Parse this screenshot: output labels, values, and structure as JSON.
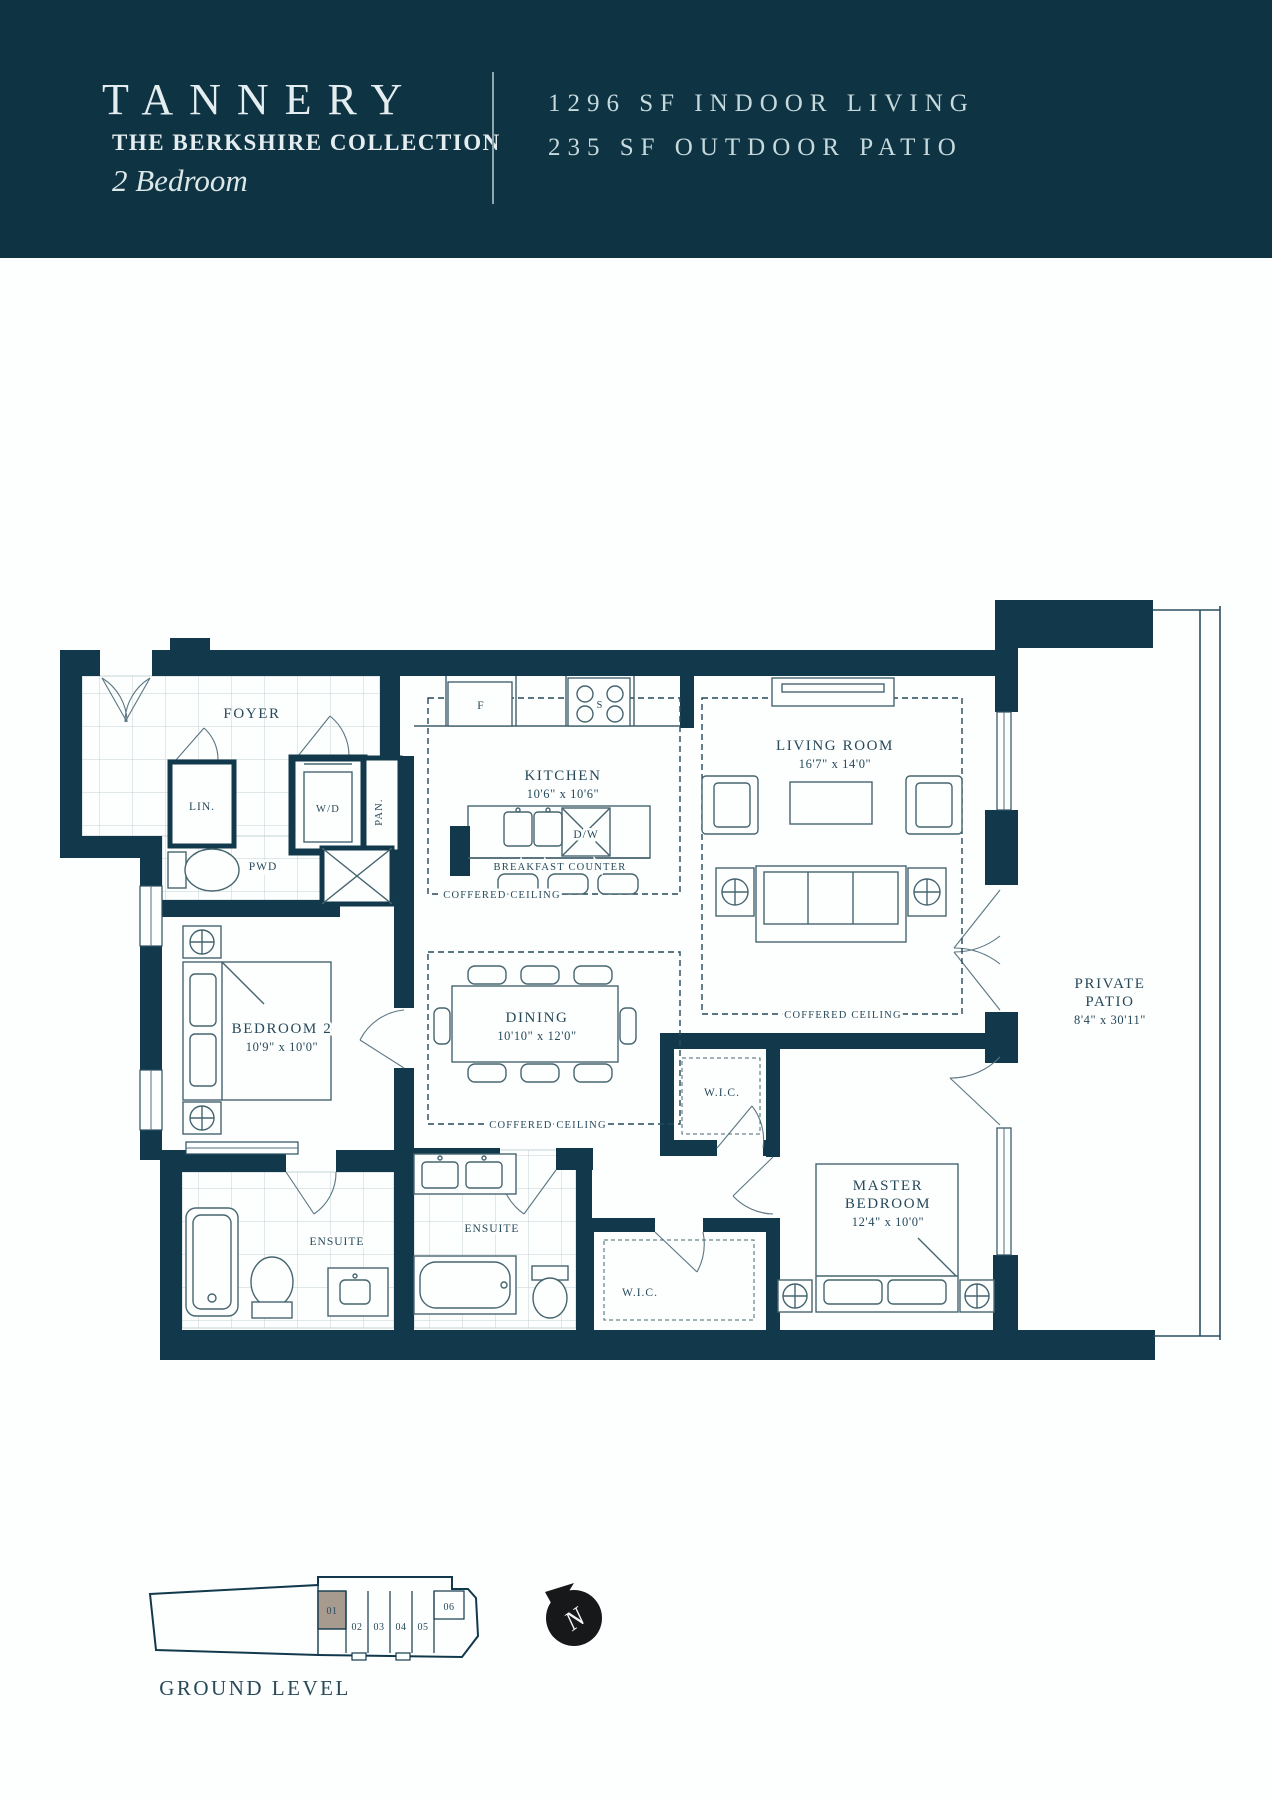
{
  "header": {
    "title": "TANNERY",
    "collection": "THE BERKSHIRE COLLECTION",
    "unit_type": "2 Bedroom",
    "stat1": "1296 SF INDOOR LIVING",
    "stat2": "235 SF OUTDOOR PATIO"
  },
  "plan": {
    "foyer": "FOYER",
    "lin": "LIN.",
    "wd": "W/D",
    "pan": "PAN.",
    "pwd": "PWD",
    "kitchen": "KITCHEN",
    "kitchen_dims": "10'6\" x 10'6\"",
    "fridge": "F",
    "stove": "S",
    "dishwasher": "D/W",
    "breakfast_counter": "BREAKFAST COUNTER",
    "coffered": "COFFERED CEILING",
    "living": "LIVING ROOM",
    "living_dims": "16'7\" x 14'0\"",
    "dining": "DINING",
    "dining_dims": "10'10\" x 12'0\"",
    "bedroom2": "BEDROOM 2",
    "bedroom2_dims": "10'9\" x 10'0\"",
    "master_line1": "MASTER",
    "master_line2": "BEDROOM",
    "master_dims": "12'4\" x 10'0\"",
    "patio_line1": "PRIVATE",
    "patio_line2": "PATIO",
    "patio_dims": "8'4\" x 30'11\"",
    "wic": "W.I.C.",
    "ensuite": "ENSUITE"
  },
  "keyplan": {
    "level_label": "GROUND LEVEL",
    "units": [
      "01",
      "02",
      "03",
      "04",
      "05",
      "06"
    ],
    "highlighted_unit": "01",
    "north": "N"
  },
  "colors": {
    "wall": "#12394B",
    "header_bg": "#0E3343",
    "header_text": "#C6D9DD",
    "plan_label": "#27495A",
    "tile_line": "#C5D1D6",
    "highlight_unit_fill": "#A79B90"
  }
}
